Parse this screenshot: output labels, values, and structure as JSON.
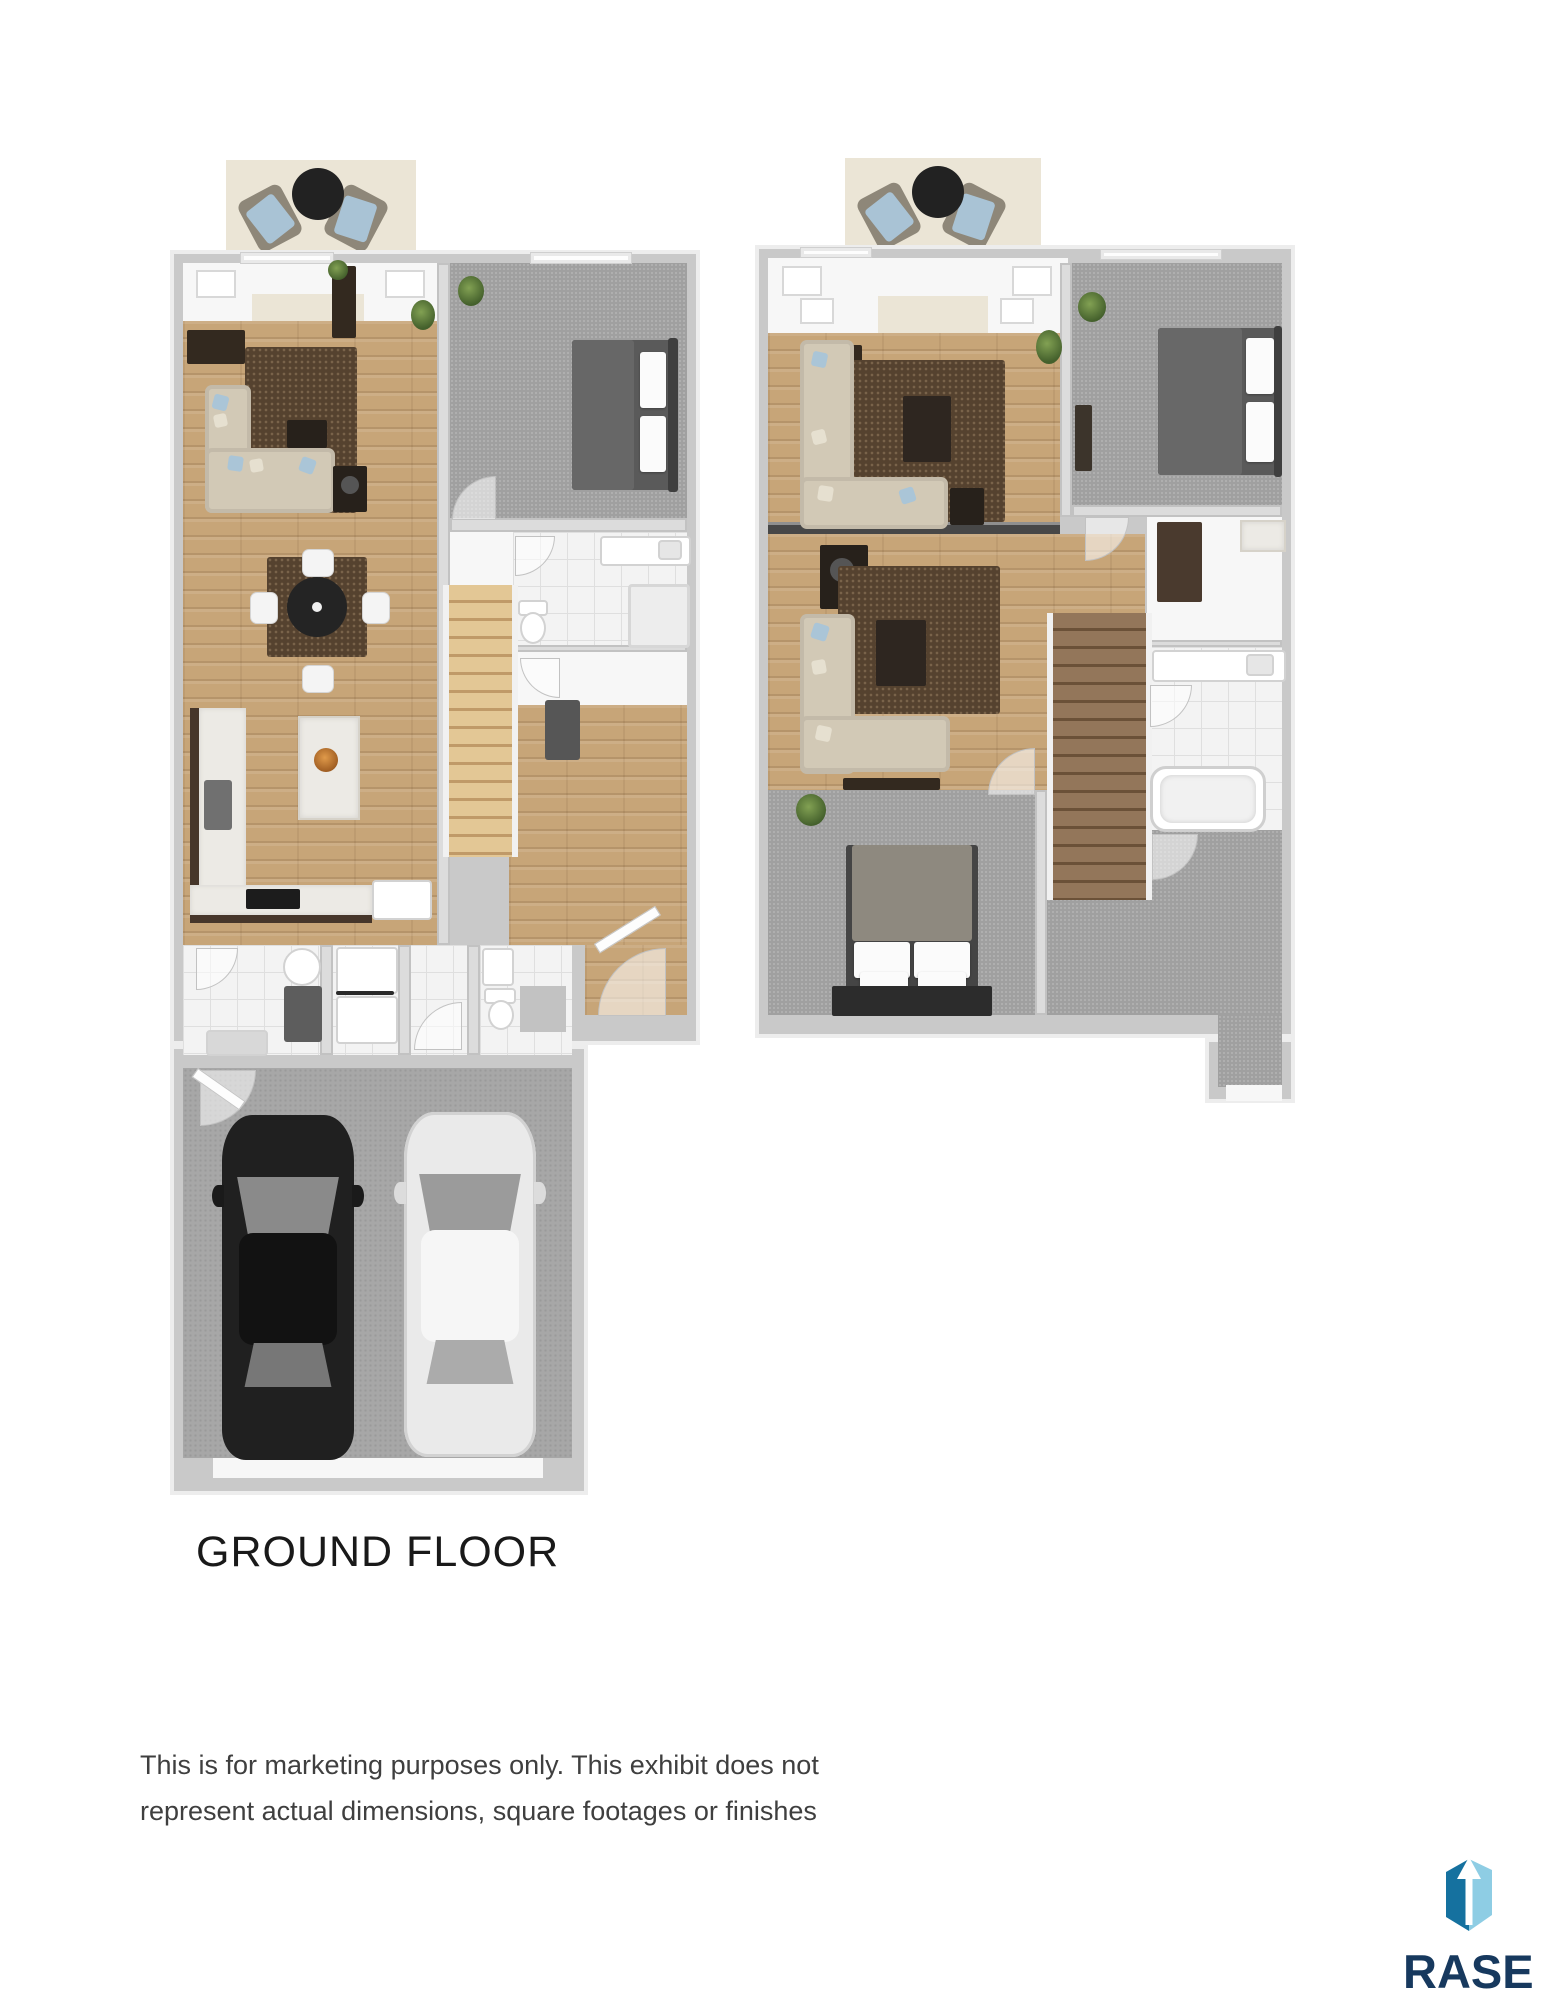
{
  "plans": {
    "ground_floor": {
      "label": "GROUND FLOOR",
      "rooms": [
        "patio",
        "living-room",
        "dining-area",
        "kitchen",
        "bedroom",
        "bathroom",
        "stairs",
        "hallway",
        "entry",
        "laundry-room",
        "powder-room",
        "garage"
      ],
      "vehicles": [
        "black-car",
        "white-car"
      ]
    },
    "upper_floor": {
      "rooms": [
        "patio",
        "family-room",
        "bedroom",
        "living-room",
        "hallway",
        "stairs",
        "bathroom",
        "master-bedroom",
        "walk-in-closet"
      ]
    }
  },
  "disclaimer": {
    "line1": "This is for marketing purposes only. This exhibit does not",
    "line2": "represent actual dimensions, square footages or finishes"
  },
  "logo": {
    "name": "RASE",
    "icon": "rase-building-arrow-up-icon",
    "colors": {
      "icon_dark_blue": "#15719F",
      "icon_light_blue": "#8ECDE4",
      "wordmark_navy": "#17395E"
    }
  },
  "palette": {
    "wall": "#C9C9C9",
    "hardwood": "#C7A578",
    "carpet": "#A0A0A0",
    "tile": "#F3F3F3",
    "concrete": "#A7A7A7",
    "area_rug": "#55422F",
    "sofa": "#D2C9B6",
    "pillow_blue": "#AAC5D7",
    "patio_mat": "#EBE5D6",
    "stairs_ground": "#D9B98A",
    "stairs_upper": "#8A7055",
    "car_black": "#202020",
    "car_white": "#EAEAEA"
  }
}
